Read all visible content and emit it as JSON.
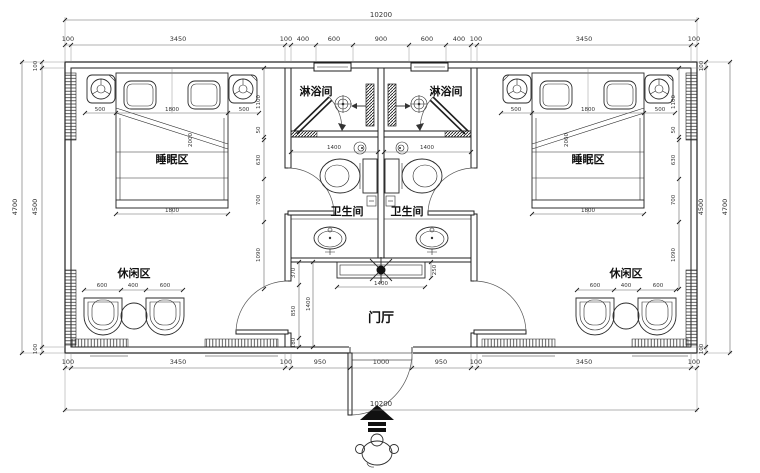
{
  "rooms": {
    "shower": "淋浴间",
    "wc": "卫生间",
    "sleep": "睡眠区",
    "leisure": "休闲区",
    "hall": "门厅"
  },
  "dims": {
    "total": "10200",
    "top_row": [
      "100",
      "3450",
      "100",
      "400",
      "600",
      "900",
      "600",
      "400",
      "100",
      "3450",
      "100"
    ],
    "bottom_row": [
      "100",
      "3450",
      "100",
      "950",
      "1000",
      "950",
      "100",
      "3450",
      "100"
    ],
    "side_outer": "4700",
    "side_inner": "4500",
    "wall": "100",
    "room_chain": [
      "1100",
      "50",
      "630",
      "700",
      "1090"
    ],
    "hall_chain": [
      "370",
      "850",
      "180"
    ],
    "hall_depth": "1400",
    "cabinet_width": "1400",
    "cabinet_depth": "250",
    "bath_width": "1400",
    "bed_side": "500",
    "bed_width": "1800",
    "bed_length": "2000",
    "chair_width": "600",
    "table_width": "400"
  }
}
